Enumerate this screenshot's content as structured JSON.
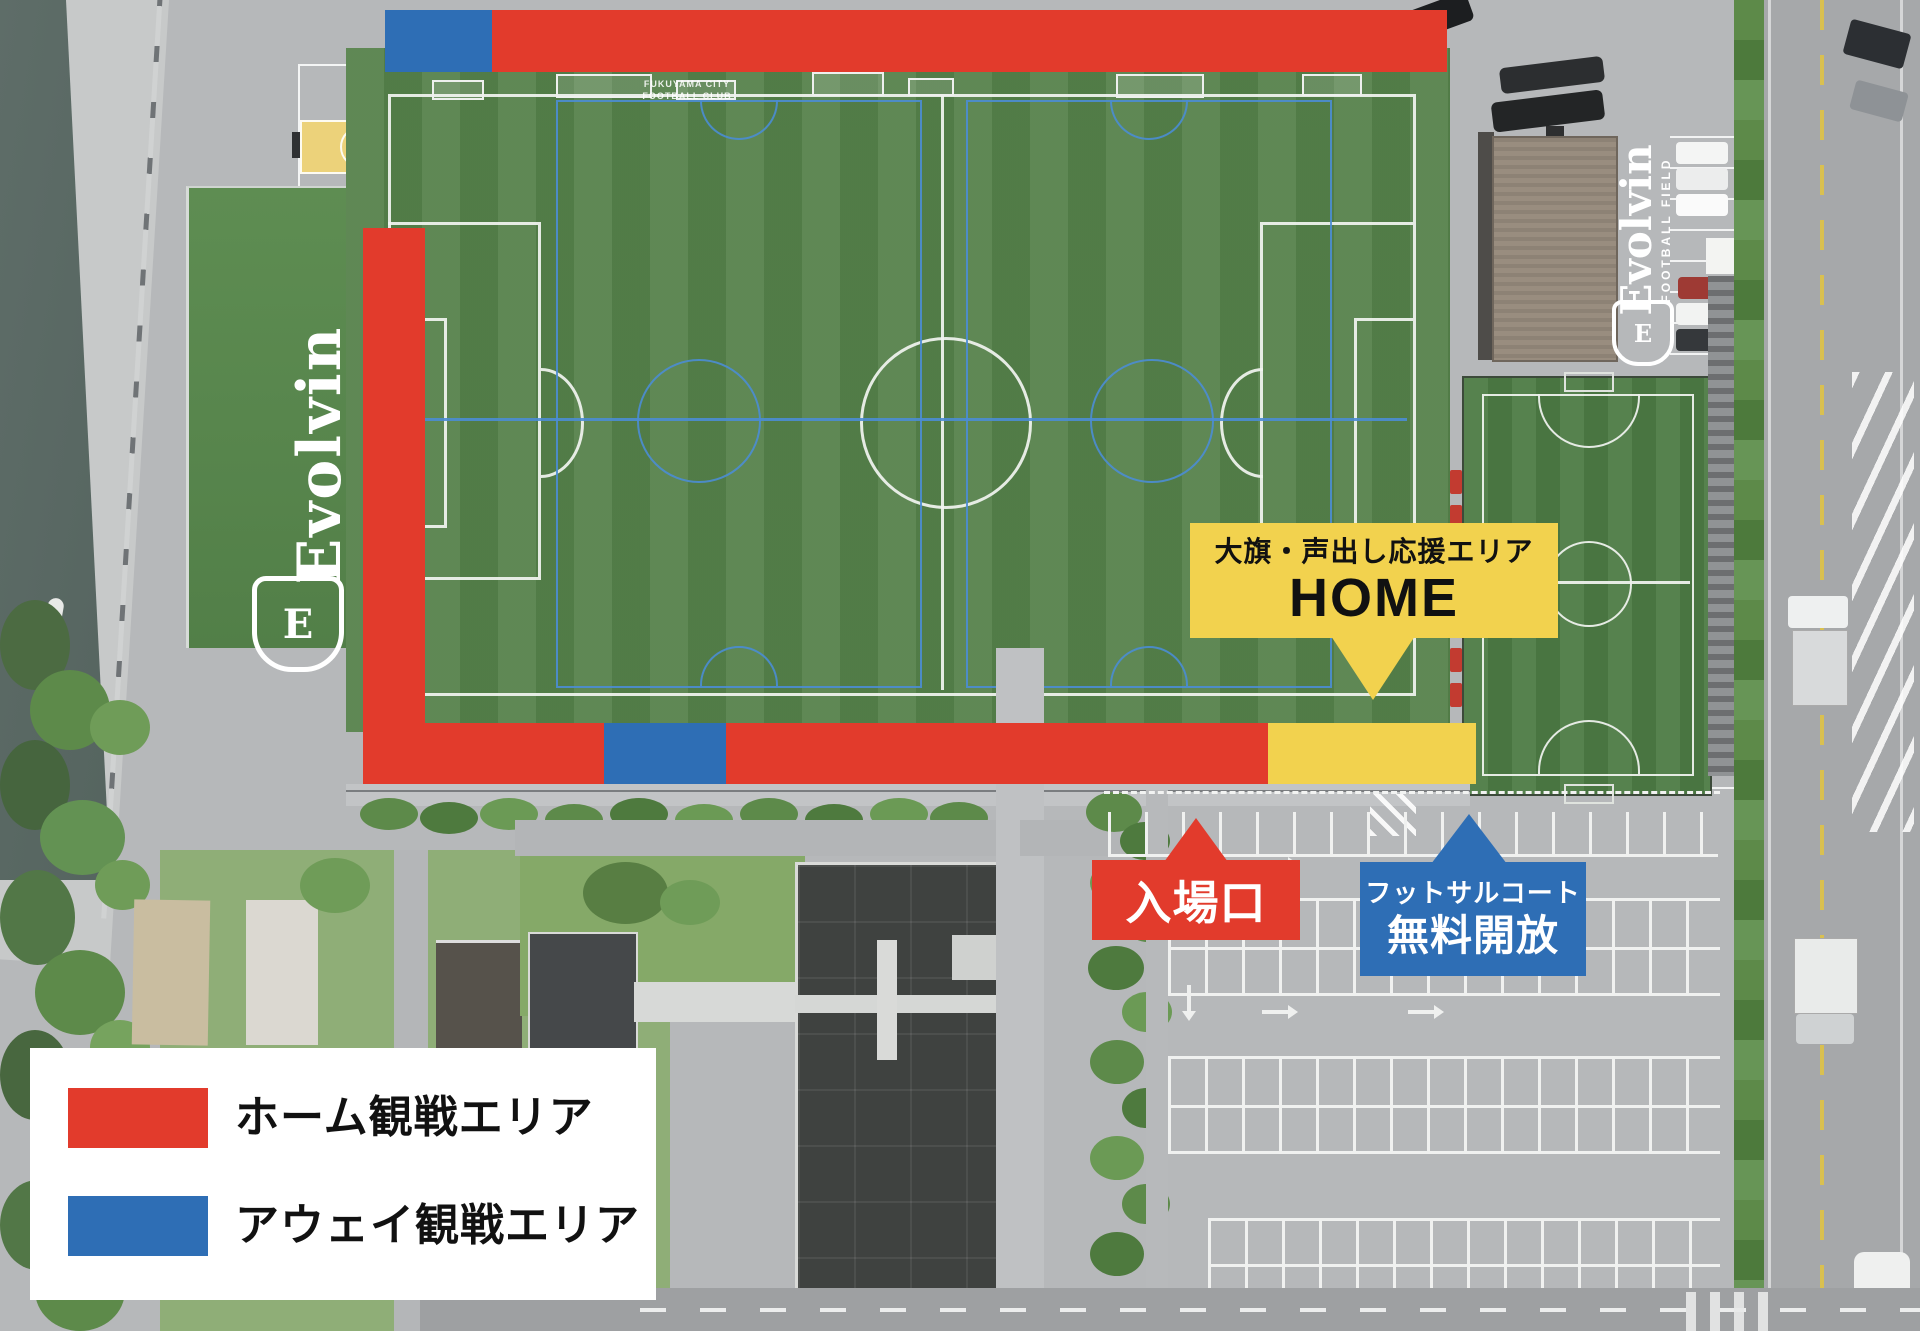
{
  "map": {
    "colors": {
      "home_red": "#e23b2c",
      "away_blue": "#2e6eb5",
      "support_yellow": "#f2d24e"
    },
    "legend": {
      "items": [
        {
          "id": "home",
          "label": "ホーム観戦エリア"
        },
        {
          "id": "away",
          "label": "アウェイ観戦エリア"
        }
      ]
    },
    "callouts": {
      "support": {
        "line1": "大旗・声出し応援エリア",
        "line2": "HOME"
      },
      "entrance": {
        "label": "入場口"
      },
      "futsal": {
        "line1": "フットサルコート",
        "line2": "無料開放"
      }
    },
    "ground_labels": {
      "club_line1": "FUKUYAMA CITY",
      "club_line2": "FOOTBALL CLUB",
      "bank_brand": "Evolvin",
      "roof_brand": "Evolvin",
      "roof_sub": "FOOTBALL FIELD",
      "crest_letter": "E"
    }
  }
}
